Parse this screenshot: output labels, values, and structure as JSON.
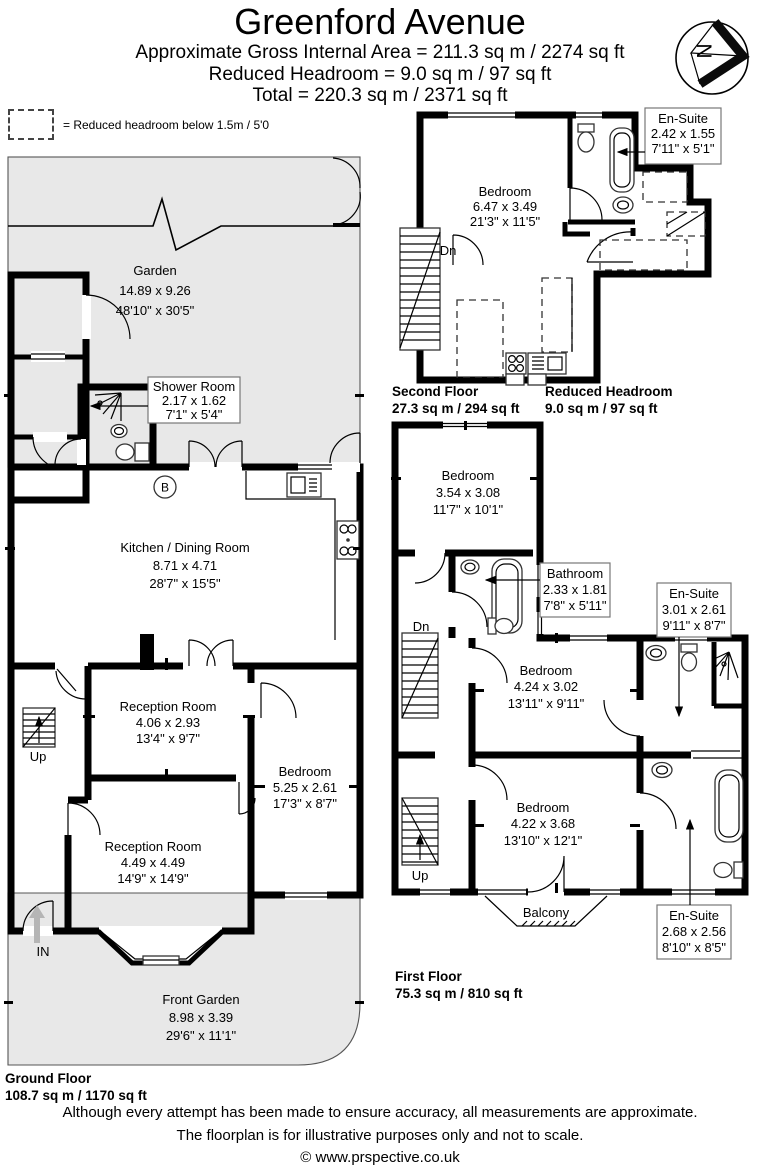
{
  "header": {
    "title": "Greenford Avenue",
    "subtitle1": "Approximate Gross Internal Area = 211.3 sq m / 2274 sq ft",
    "subtitle2": "Reduced Headroom = 9.0 sq m / 97 sq ft",
    "subtitle3": "Total = 220.3 sq m / 2371 sq ft"
  },
  "legend": {
    "text": "= Reduced headroom below 1.5m / 5'0"
  },
  "compass": {
    "north": "N"
  },
  "ground": {
    "caption": "Ground Floor",
    "area": "108.7 sq m / 1170 sq ft",
    "garden": {
      "n": "Garden",
      "m": "14.89 x 9.26",
      "i": "48'10\" x 30'5\""
    },
    "shower": {
      "n": "Shower Room",
      "m": "2.17 x 1.62",
      "i": "7'1\" x 5'4\""
    },
    "kitchen": {
      "n": "Kitchen / Dining Room",
      "m": "8.71 x 4.71",
      "i": "28'7\" x 15'5\""
    },
    "reception1": {
      "n": "Reception Room",
      "m": "4.06 x 2.93",
      "i": "13'4\" x 9'7\""
    },
    "reception2": {
      "n": "Reception Room",
      "m": "4.49 x 4.49",
      "i": "14'9\" x 14'9\""
    },
    "bedroom": {
      "n": "Bedroom",
      "m": "5.25 x 2.61",
      "i": "17'3\" x 8'7\""
    },
    "front_garden": {
      "n": "Front Garden",
      "m": "8.98 x 3.39",
      "i": "29'6\" x 11'1\""
    },
    "up": "Up",
    "entrance": "IN",
    "boiler": "B"
  },
  "first": {
    "caption": "First Floor",
    "area": "75.3 sq m / 810 sq ft",
    "bedroom1": {
      "n": "Bedroom",
      "m": "3.54 x 3.08",
      "i": "11'7\" x 10'1\""
    },
    "bathroom": {
      "n": "Bathroom",
      "m": "2.33 x 1.81",
      "i": "7'8\" x 5'11\""
    },
    "ensuite1": {
      "n": "En-Suite",
      "m": "3.01 x 2.61",
      "i": "9'11\" x 8'7\""
    },
    "bedroom2": {
      "n": "Bedroom",
      "m": "4.24 x 3.02",
      "i": "13'11\" x 9'11\""
    },
    "bedroom3": {
      "n": "Bedroom",
      "m": "4.22 x 3.68",
      "i": "13'10\" x 12'1\""
    },
    "ensuite2": {
      "n": "En-Suite",
      "m": "2.68 x 2.56",
      "i": "8'10\" x 8'5\""
    },
    "balcony": "Balcony",
    "dn": "Dn",
    "up": "Up"
  },
  "second": {
    "caption": "Second Floor",
    "area": "27.3 sq m / 294 sq ft",
    "reduced_caption": "Reduced Headroom",
    "reduced_area": "9.0 sq m / 97 sq ft",
    "bedroom": {
      "n": "Bedroom",
      "m": "6.47 x 3.49",
      "i": "21'3\" x 11'5\""
    },
    "ensuite": {
      "n": "En-Suite",
      "m": "2.42 x 1.55",
      "i": "7'11\" x 5'1\""
    },
    "dn": "Dn"
  },
  "footer": {
    "line1": "Although every attempt has been made to ensure accuracy, all measurements are approximate.",
    "line2": "The floorplan is for illustrative purposes only and not to scale.",
    "copyright": "© www.prspective.co.uk"
  }
}
